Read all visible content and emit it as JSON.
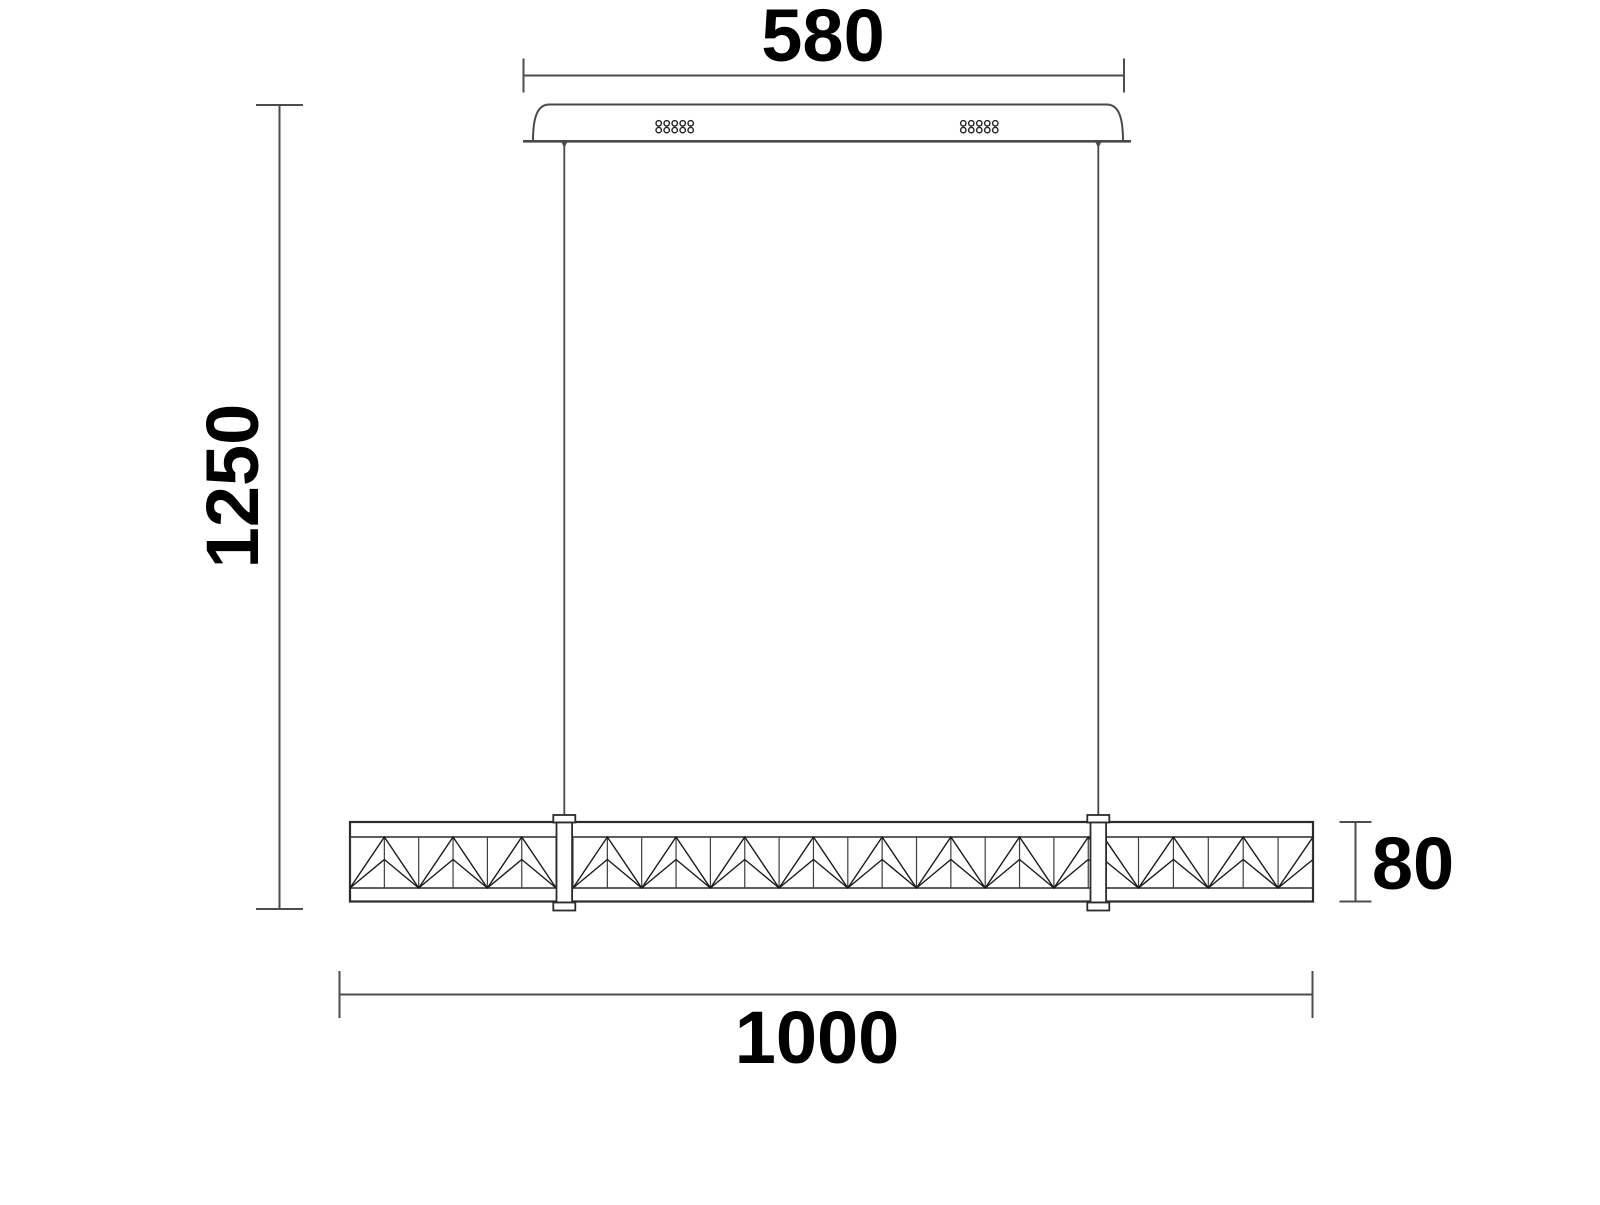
{
  "drawing": {
    "kind": "technical-dimension-drawing",
    "palette": {
      "background": "#ffffff",
      "outline": "#2b2b2b",
      "pattern_line": "#1a1a1a",
      "pattern_vertical": "#3f3f3f",
      "dim_line": "#4d4d4d",
      "canopy_line": "#4a4a4a",
      "cable": "#4a4a4a",
      "text": "#000000"
    },
    "font_size": 74,
    "annotations": [
      {
        "id": "canopy-width",
        "value": "580",
        "axis": "x",
        "line": {
          "x1": 523.5,
          "x2": 1124,
          "y": 75.5
        },
        "tick_len": 34,
        "text": {
          "x": 823,
          "y": 61,
          "rotate": 0
        }
      },
      {
        "id": "overall-drop",
        "value": "1250",
        "axis": "y",
        "line": {
          "y1": 105,
          "y2": 909,
          "x": 279.5
        },
        "tick_len": 47,
        "text": {
          "x": 258,
          "y": 486,
          "rotate": -90
        }
      },
      {
        "id": "fixture-length",
        "value": "1000",
        "axis": "x",
        "line": {
          "x1": 339.5,
          "x2": 1312.5,
          "y": 994.5
        },
        "tick_len": 47,
        "text": {
          "x": 817,
          "y": 1063,
          "rotate": 0
        }
      },
      {
        "id": "fixture-height",
        "value": "80",
        "axis": "y",
        "line": {
          "y1": 822,
          "y2": 901.5,
          "x": 1355.5
        },
        "tick_len": 32,
        "text": {
          "x": 1413,
          "y": 889,
          "rotate": 0
        }
      }
    ],
    "canopy": {
      "body": {
        "x1": 533,
        "x2": 1123,
        "y1": 104.5,
        "y2": 141,
        "end_curve": 16.5
      },
      "plate": {
        "x1": 523,
        "x2": 1131,
        "y": 141.3
      },
      "hole_clusters": [
        {
          "x": 658.7,
          "y": 123.3,
          "cols": 5,
          "rows": 2,
          "dx": 8,
          "dy": 6.8,
          "r": 2.7
        },
        {
          "x": 963.3,
          "y": 123.3,
          "cols": 5,
          "rows": 2,
          "dx": 8,
          "dy": 6.8,
          "r": 2.7
        }
      ]
    },
    "cables": [
      {
        "x": 564.3
      },
      {
        "x": 1098.3
      }
    ],
    "cable_top_y": 142,
    "cable_bottom_y": 816,
    "bar": {
      "x1": 350,
      "x2": 1313,
      "y1": 822,
      "y2": 901.5,
      "inner_top": 837,
      "inner_bottom": 888,
      "inner_peak_y": 859.5
    },
    "pattern_sections": [
      {
        "x1": 350,
        "x2": 557,
        "valley_x": 350,
        "period": 68.7
      },
      {
        "x1": 572.5,
        "x2": 1089.5,
        "valley_x": 573,
        "period": 68.7
      },
      {
        "x1": 1106.5,
        "x2": 1313,
        "valley_x": 1138.5,
        "period": 69.8
      }
    ],
    "sleeve": {
      "body_hw": 7.8,
      "cap_hw": 11,
      "cap_top_y": 815,
      "body_top_y": 822.5,
      "body_bot_y": 902.5,
      "cap_bot_y": 910.5
    }
  }
}
